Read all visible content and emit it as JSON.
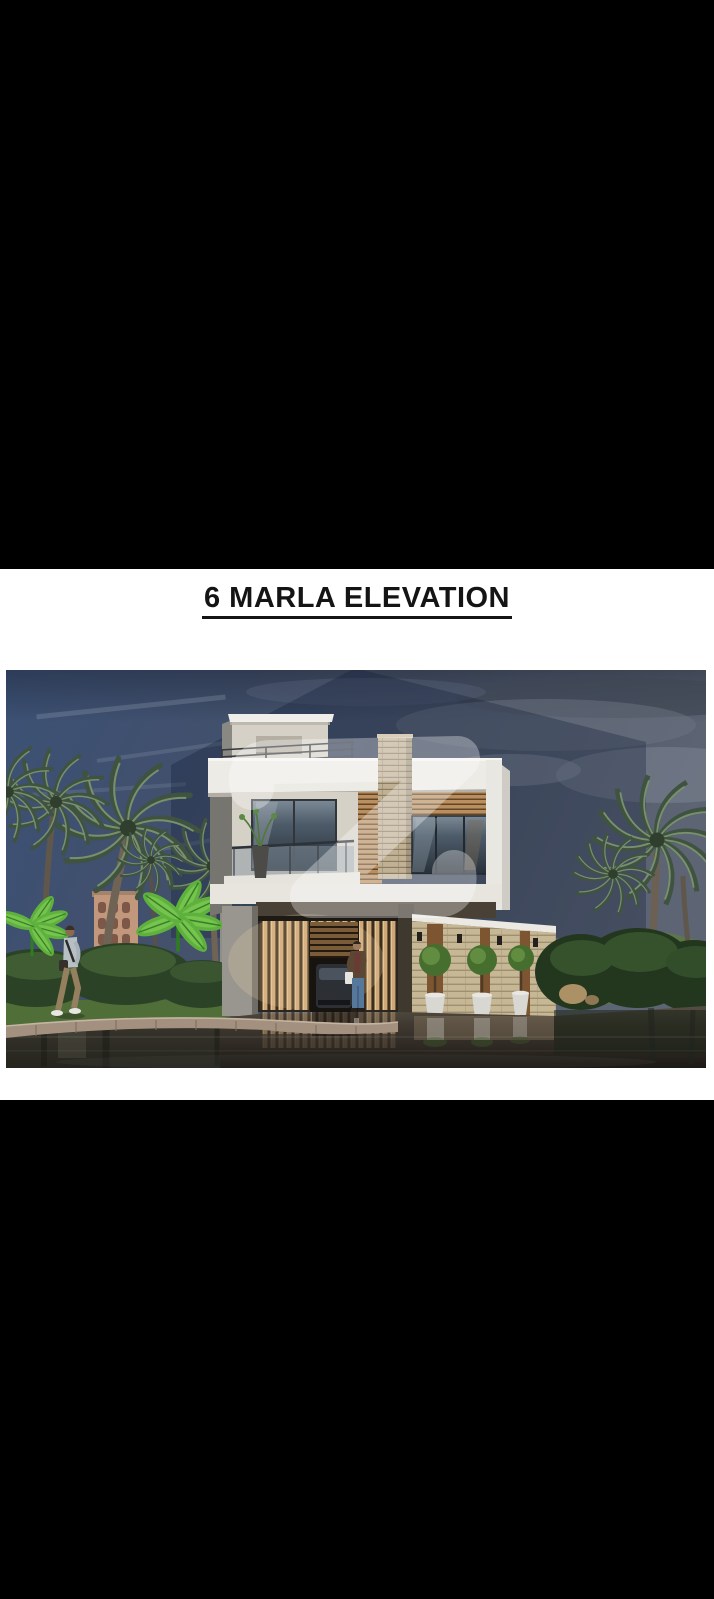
{
  "window": {
    "letterbox_color": "#000000"
  },
  "sheet": {
    "background": "#ffffff",
    "title": "6 MARLA ELEVATION",
    "title_color": "#141414"
  },
  "photo": {
    "subject": "two-storey modern house front elevation render",
    "colors": {
      "sky_left_blue": "#3c5175",
      "sky_right_grey": "#5d6473",
      "cloud_light": "#8d95a2",
      "cloud_dark": "#3f4754",
      "watermark_shade": "#0d1b36",
      "watermark_glyph": "#ffffff",
      "palm_frond": "#3f5340",
      "palm_frond_light": "#78906c",
      "palm_trunk": "#6e6354",
      "banana_leaf": "#5fb13e",
      "bush_green": "#2c4227",
      "grass": "#4f6e38",
      "background_building": "#c2987c",
      "pedestrian_shirt": "#b7c0c5",
      "pedestrian_trousers": "#94805e",
      "house_white": "#edebe6",
      "house_cream": "#d6d1c7",
      "side_wall_grey": "#8f8d88",
      "wood_slat": "#c09466",
      "stone_ledger": "#c6b795",
      "glass_dark": "#273039",
      "soffit_dark": "#4a4136",
      "gate_wood": "#cfa878",
      "garage_interior": "#17130f",
      "car_body": "#2c2f34",
      "person_jacket": "#5a4834",
      "person_jeans": "#56799b",
      "wood_panel": "#7d5631",
      "topiary_green": "#466f2f",
      "pot_white": "#d8d7d2",
      "hedge_dark": "#23371f",
      "lawn_mound": "#5d7a44",
      "rock_tan": "#ad9166",
      "kerb": "#a3907f",
      "road_top": "#564e44",
      "road_bottom": "#1d1914"
    }
  }
}
